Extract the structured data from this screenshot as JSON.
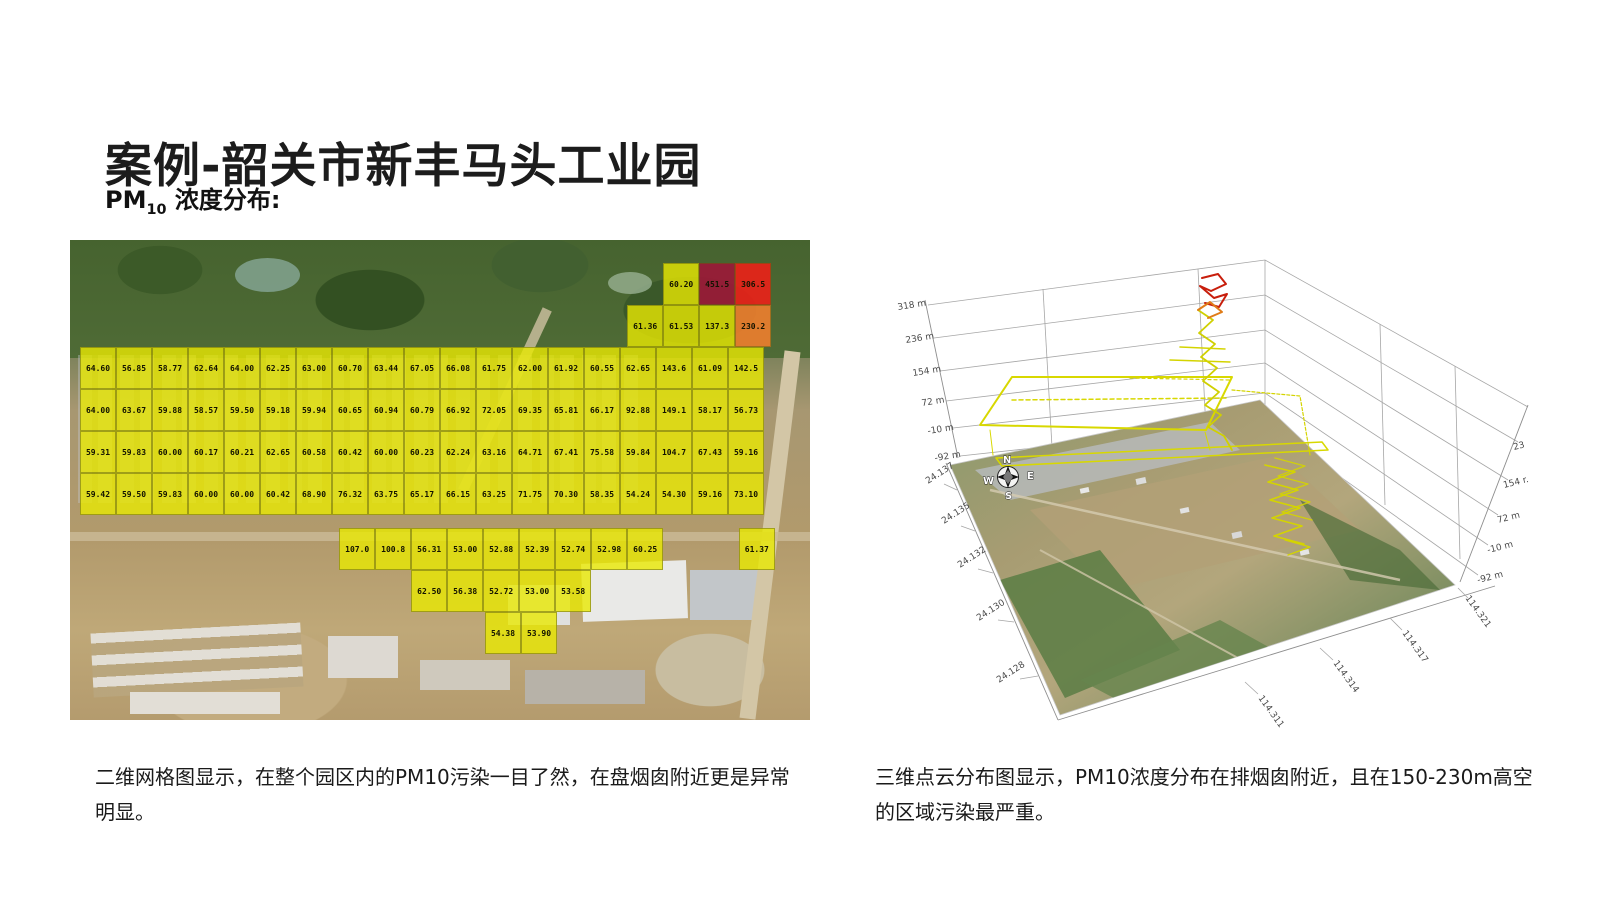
{
  "slide": {
    "title": "案例-韶关市新丰马头工业园",
    "subtitle": {
      "prefix": "PM",
      "sub": "10",
      "suffix": " 浓度分布:"
    },
    "captions": {
      "left": "二维网格图显示，在整个园区内的PM10污染一目了然，在盘烟囱附近更是异常明显。",
      "right": "三维点云分布图显示，PM10浓度分布在排烟囱附近，且在150-230m高空的区域污染最严重。"
    }
  },
  "chart_data": [
    {
      "type": "heatmap",
      "title": "PM10 2D grid concentration values overlaid on satellite map",
      "colors": {
        "y": "rgba(233,233,2,0.8)",
        "dr": "rgba(158,22,56,0.88)",
        "r": "rgba(236,32,24,0.9)",
        "o": "rgba(238,126,45,0.9)"
      },
      "x0": 10,
      "cell_w": 36,
      "cell_h": 42,
      "rows": [
        {
          "top": 23,
          "cells": [
            [
              16.2,
              "60.20"
            ],
            [
              17.2,
              "451.5",
              "dr"
            ],
            [
              18.2,
              "306.5",
              "r"
            ]
          ]
        },
        {
          "top": 65,
          "cells": [
            [
              15.2,
              "61.36"
            ],
            [
              16.2,
              "61.53"
            ],
            [
              17.2,
              "137.3"
            ],
            [
              18.2,
              "230.2",
              "o"
            ]
          ]
        },
        {
          "top": 107,
          "cells": [
            [
              0,
              "64.60"
            ],
            [
              1,
              "56.85"
            ],
            [
              2,
              "58.77"
            ],
            [
              3,
              "62.64"
            ],
            [
              4,
              "64.00"
            ],
            [
              5,
              "62.25"
            ],
            [
              6,
              "63.00"
            ],
            [
              7,
              "60.70"
            ],
            [
              8,
              "63.44"
            ],
            [
              9,
              "67.05"
            ],
            [
              10,
              "66.08"
            ],
            [
              11,
              "61.75"
            ],
            [
              12,
              "62.00"
            ],
            [
              13,
              "61.92"
            ],
            [
              14,
              "60.55"
            ],
            [
              15,
              "62.65"
            ],
            [
              16,
              "143.6"
            ],
            [
              17,
              "61.09"
            ],
            [
              18,
              "142.5"
            ]
          ]
        },
        {
          "top": 149,
          "cells": [
            [
              0,
              "64.00"
            ],
            [
              1,
              "63.67"
            ],
            [
              2,
              "59.88"
            ],
            [
              3,
              "58.57"
            ],
            [
              4,
              "59.50"
            ],
            [
              5,
              "59.18"
            ],
            [
              6,
              "59.94"
            ],
            [
              7,
              "60.65"
            ],
            [
              8,
              "60.94"
            ],
            [
              9,
              "60.79"
            ],
            [
              10,
              "66.92"
            ],
            [
              11,
              "72.05"
            ],
            [
              12,
              "69.35"
            ],
            [
              13,
              "65.81"
            ],
            [
              14,
              "66.17"
            ],
            [
              15,
              "92.88"
            ],
            [
              16,
              "149.1"
            ],
            [
              17,
              "58.17"
            ],
            [
              18,
              "56.73"
            ]
          ]
        },
        {
          "top": 191,
          "cells": [
            [
              0,
              "59.31"
            ],
            [
              1,
              "59.83"
            ],
            [
              2,
              "60.00"
            ],
            [
              3,
              "60.17"
            ],
            [
              4,
              "60.21"
            ],
            [
              5,
              "62.65"
            ],
            [
              6,
              "60.58"
            ],
            [
              7,
              "60.42"
            ],
            [
              8,
              "60.00"
            ],
            [
              9,
              "60.23"
            ],
            [
              10,
              "62.24"
            ],
            [
              11,
              "63.16"
            ],
            [
              12,
              "64.71"
            ],
            [
              13,
              "67.41"
            ],
            [
              14,
              "75.58"
            ],
            [
              15,
              "59.84"
            ],
            [
              16,
              "104.7"
            ],
            [
              17,
              "67.43"
            ],
            [
              18,
              "59.16"
            ]
          ]
        },
        {
          "top": 233,
          "cells": [
            [
              0,
              "59.42"
            ],
            [
              1,
              "59.50"
            ],
            [
              2,
              "59.83"
            ],
            [
              3,
              "60.00"
            ],
            [
              4,
              "60.00"
            ],
            [
              5,
              "60.42"
            ],
            [
              6,
              "68.90"
            ],
            [
              7,
              "76.32"
            ],
            [
              8,
              "63.75"
            ],
            [
              9,
              "65.17"
            ],
            [
              10,
              "66.15"
            ],
            [
              11,
              "63.25"
            ],
            [
              12,
              "71.75"
            ],
            [
              13,
              "70.30"
            ],
            [
              14,
              "58.35"
            ],
            [
              15,
              "54.24"
            ],
            [
              16,
              "54.30"
            ],
            [
              17,
              "59.16"
            ],
            [
              18,
              "73.10"
            ]
          ]
        },
        {
          "top": 288,
          "cells": [
            [
              7.2,
              "107.0"
            ],
            [
              8.2,
              "100.8"
            ],
            [
              9.2,
              "56.31"
            ],
            [
              10.2,
              "53.00"
            ],
            [
              11.2,
              "52.88"
            ],
            [
              12.2,
              "52.39"
            ],
            [
              13.2,
              "52.74"
            ],
            [
              14.2,
              "52.98"
            ],
            [
              15.2,
              "60.25"
            ],
            [
              18.3,
              "61.37"
            ]
          ]
        },
        {
          "top": 330,
          "cells": [
            [
              9.2,
              "62.50"
            ],
            [
              10.2,
              "56.38"
            ],
            [
              11.2,
              "52.72"
            ],
            [
              12.2,
              "53.00"
            ],
            [
              13.2,
              "53.58"
            ]
          ]
        },
        {
          "top": 372,
          "cells": [
            [
              11.25,
              "54.38"
            ],
            [
              12.25,
              "53.90"
            ]
          ]
        }
      ]
    },
    {
      "type": "scatter3d",
      "title": "PM10 3D point-cloud distribution over satellite base map",
      "z_ticks_left": [
        {
          "t": "318 m",
          "x": 18,
          "y": 60
        },
        {
          "t": "236 m",
          "x": 26,
          "y": 93
        },
        {
          "t": "154 m",
          "x": 33,
          "y": 126
        },
        {
          "t": "72 m",
          "x": 42,
          "y": 156
        },
        {
          "t": "-10 m",
          "x": 48,
          "y": 184
        },
        {
          "t": "-92 m",
          "x": 55,
          "y": 211
        }
      ],
      "z_ticks_right": [
        {
          "t": "23",
          "x": 634,
          "y": 200
        },
        {
          "t": "154 r.",
          "x": 624,
          "y": 238
        },
        {
          "t": "72 m",
          "x": 618,
          "y": 273
        },
        {
          "t": "-10 m",
          "x": 608,
          "y": 303
        },
        {
          "t": "-92 m",
          "x": 598,
          "y": 333
        }
      ],
      "y_ticks": [
        {
          "t": "24.137",
          "x": 48,
          "y": 234
        },
        {
          "t": "24.135",
          "x": 64,
          "y": 274
        },
        {
          "t": "24.132",
          "x": 80,
          "y": 318
        },
        {
          "t": "24.130",
          "x": 99,
          "y": 371
        },
        {
          "t": "24.128",
          "x": 119,
          "y": 433
        }
      ],
      "x_ticks": [
        {
          "t": "114.311",
          "x": 378,
          "y": 448
        },
        {
          "t": "114.314",
          "x": 453,
          "y": 413
        },
        {
          "t": "114.317",
          "x": 522,
          "y": 383
        },
        {
          "t": "114.321",
          "x": 585,
          "y": 348
        }
      ],
      "compass": [
        {
          "t": "N",
          "x": 123,
          "y": 213
        },
        {
          "t": "W",
          "x": 103,
          "y": 234
        },
        {
          "t": "S",
          "x": 125,
          "y": 249
        },
        {
          "t": "E",
          "x": 147,
          "y": 229
        }
      ],
      "track_colors": {
        "path": "#d8d800",
        "hot": "#c81e0c",
        "warm": "#e07c18"
      }
    }
  ]
}
